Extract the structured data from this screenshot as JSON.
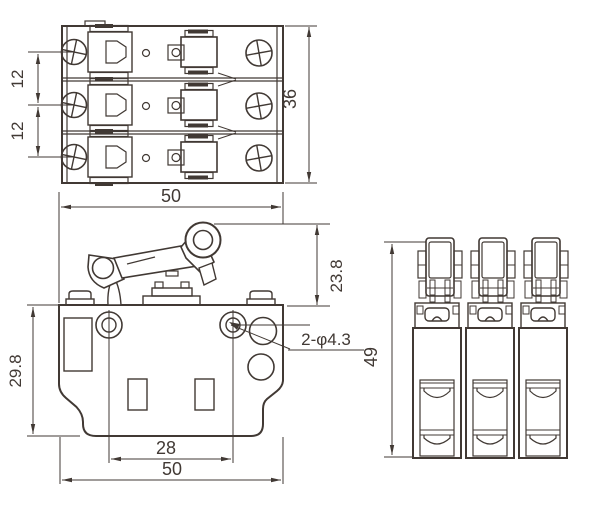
{
  "colors": {
    "line": "#413934",
    "background": "#ffffff"
  },
  "dims": {
    "top_pitch_a": "12",
    "top_pitch_b": "12",
    "top_height": "36",
    "front_width_top": "50",
    "front_lever_height": "23.8",
    "front_body_height": "29.8",
    "front_hole_spacing": "28",
    "front_width_bottom": "50",
    "front_holes_note": "2-φ4.3",
    "side_height": "49"
  }
}
